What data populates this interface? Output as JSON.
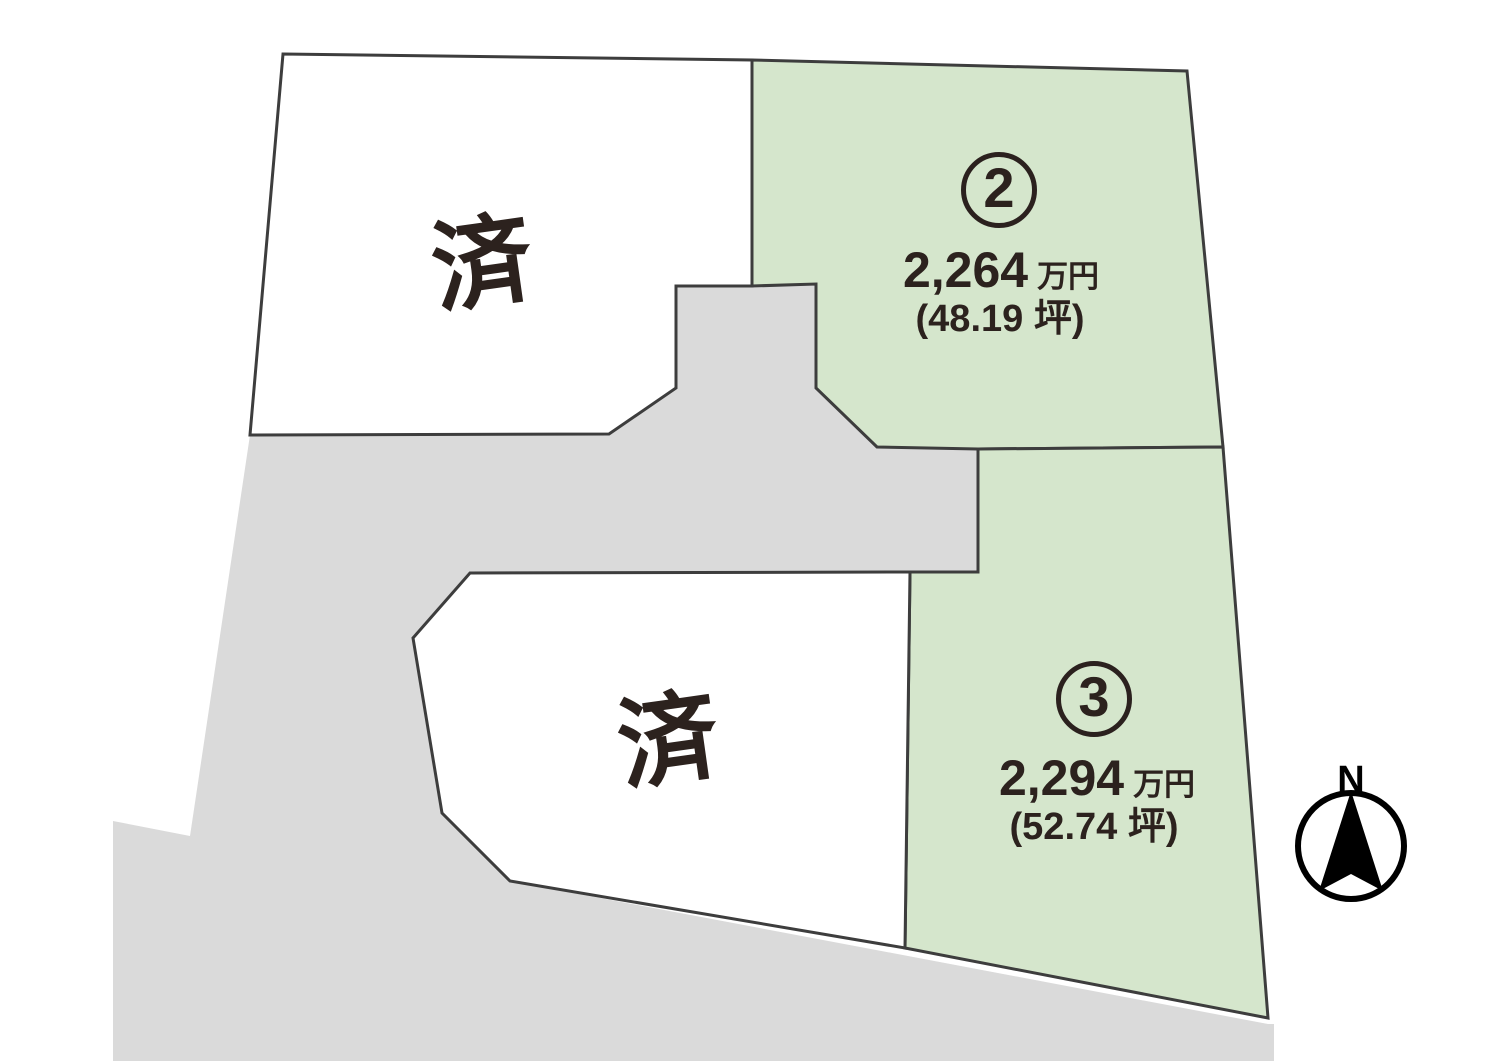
{
  "map_title": "site-plan",
  "colors": {
    "lot_available_fill": "#d5e6cc",
    "lot_sold_fill": "#ffffff",
    "road_fill": "#dadada",
    "outline": "#3d3d3d",
    "text": "#2c221e",
    "compass": "#000000"
  },
  "lots": [
    {
      "id": "sold-upper",
      "type": "sold",
      "status_label": "済"
    },
    {
      "id": "lot-2",
      "type": "available",
      "number": "2",
      "price": "2,264",
      "price_unit": "万円",
      "area": "(48.19 坪)"
    },
    {
      "id": "lot-3",
      "type": "available",
      "number": "3",
      "price": "2,294",
      "price_unit": "万円",
      "area": "(52.74 坪)"
    },
    {
      "id": "sold-lower",
      "type": "sold",
      "status_label": "済"
    }
  ],
  "compass": {
    "label": "N"
  }
}
